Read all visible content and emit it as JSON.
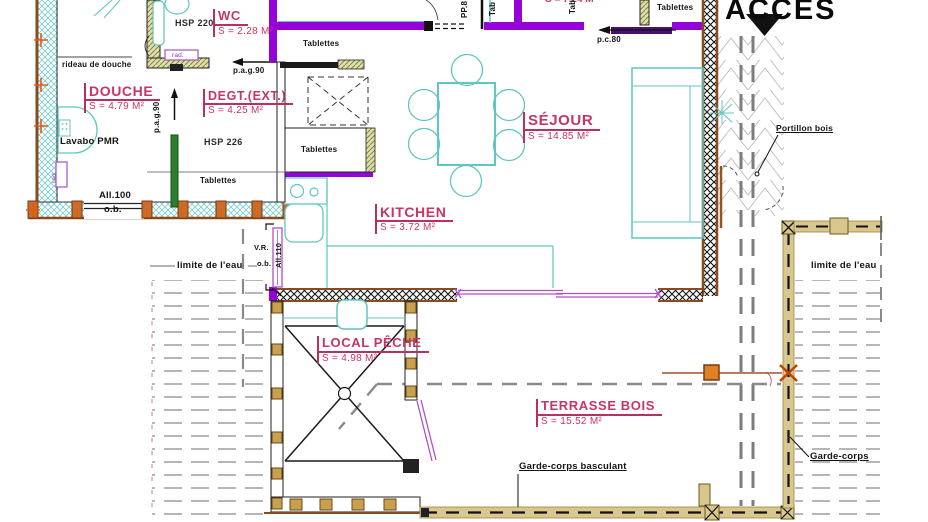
{
  "access": {
    "title": "ACCES"
  },
  "rooms": {
    "douche": {
      "name": "DOUCHE",
      "area": "S = 4.79 M²"
    },
    "wc": {
      "name": "WC",
      "area": "S = 2.28 M²"
    },
    "degt": {
      "name": "DEGT.(EXT.)",
      "area": "S = 4.25 M²"
    },
    "sejour": {
      "name": "SÉJOUR",
      "area": "S = 14.85 M²"
    },
    "kitchen": {
      "name": "KITCHEN",
      "area": "S = 3.72 M²"
    },
    "local_peche": {
      "name": "LOCAL PÊCHE",
      "area": "S = 4.98 M²"
    },
    "terrasse": {
      "name": "TERRASSE BOIS",
      "area": "S = 15.52 M²"
    },
    "partial_top": {
      "area": "S = 7.24 M²"
    }
  },
  "annotations": {
    "rideau": "rideau de douche",
    "lavabo": "Lavabo PMR",
    "hsp220": "HSP 220",
    "hsp226": "HSP 226",
    "tablettes": "Tablettes",
    "tab_vertical": "Tab",
    "rad": "rad.",
    "pag90": "p.a.g.90",
    "all100": "All.100",
    "ob": "o.b.",
    "vr": "V.R.",
    "all110": "All.110",
    "pp8": "PP.8",
    "pc80": "p.c.80",
    "limite_eau": "limite de l'eau",
    "portillon": "Portillon bois",
    "garde_corps_basculant": "Garde-corps basculant",
    "garde_corps": "Garde-corps"
  },
  "colors": {
    "wall_purple": "#9404d8",
    "window_violet": "#b14fc8",
    "furniture_cyan": "#5fc6c2",
    "room_label_pink": "#c73566",
    "fence_tan": "#d9c88e",
    "wood_brown": "#8a4a1e",
    "post_orange": "#cc6a28",
    "path_gray": "#7d7d7d"
  }
}
